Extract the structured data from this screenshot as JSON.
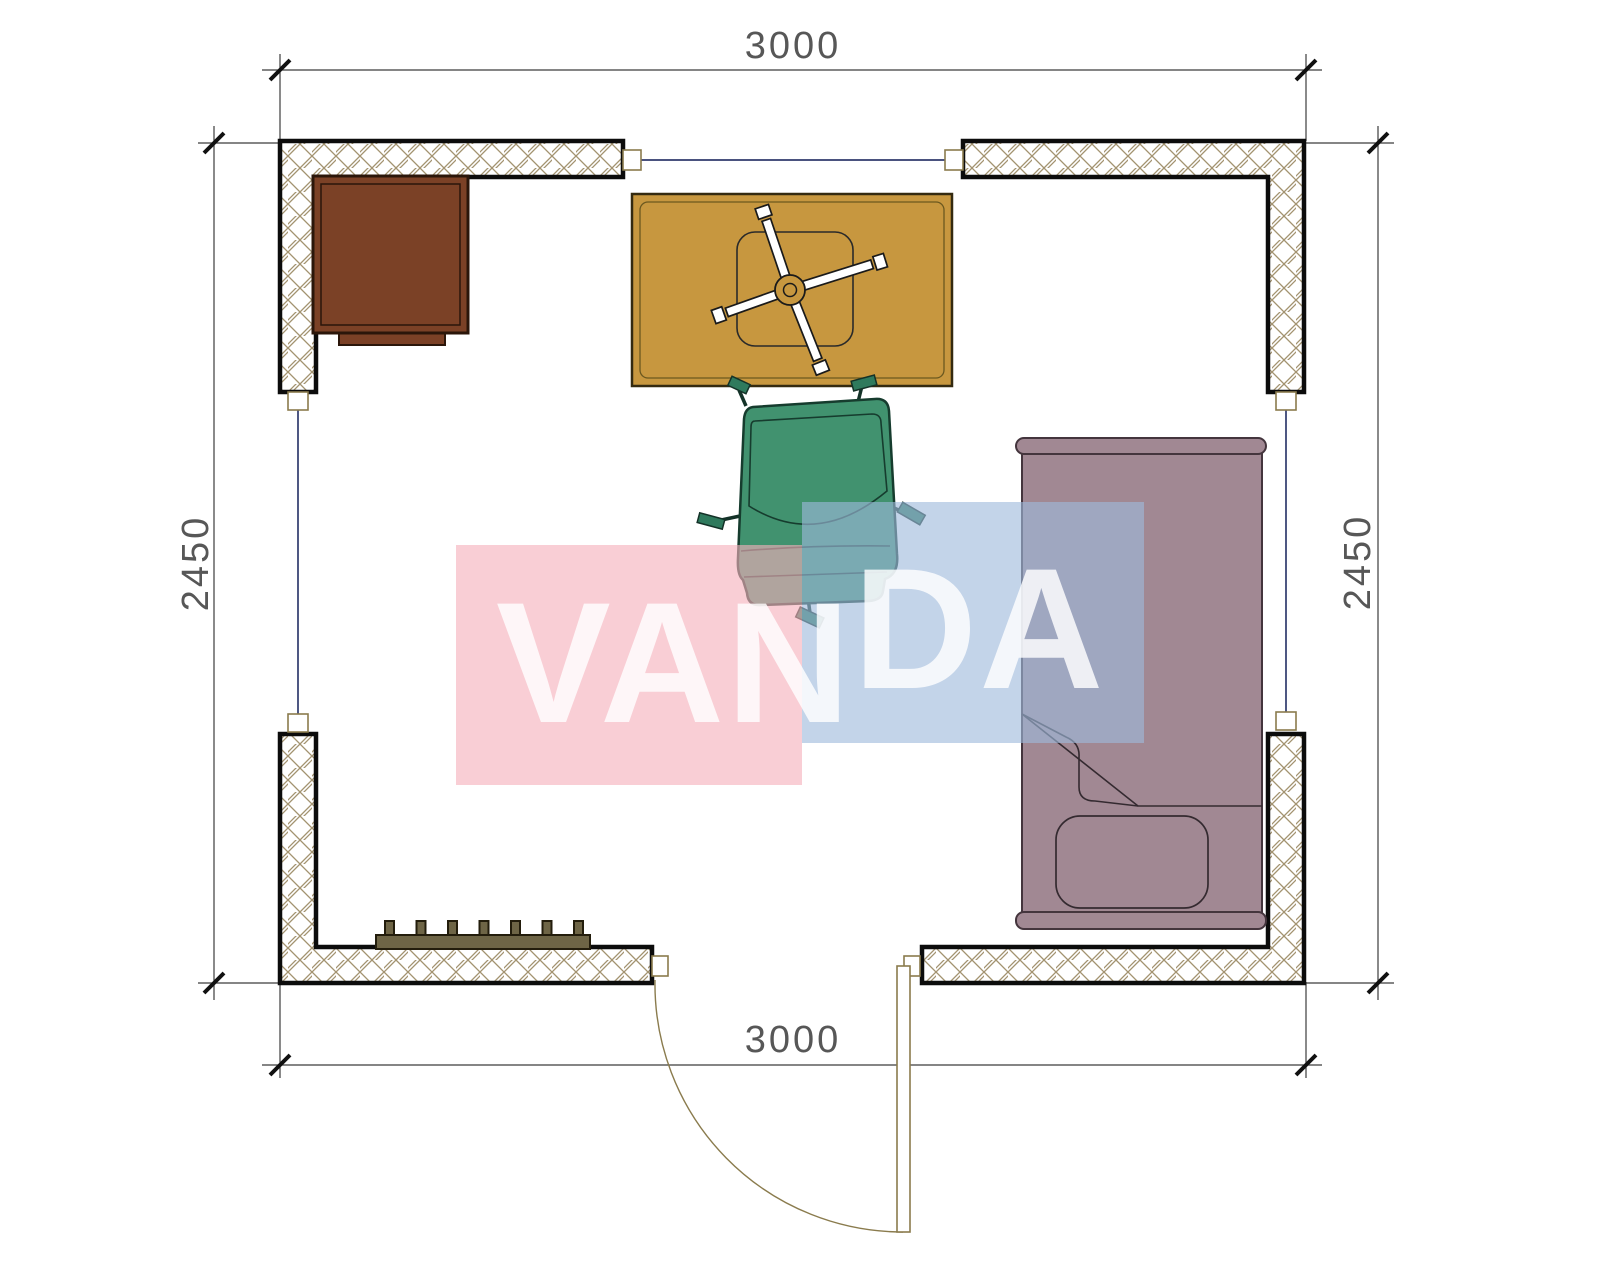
{
  "drawing": {
    "type": "room-floor-plan",
    "dimensions": {
      "top": "3000",
      "bottom": "3000",
      "left": "2450",
      "right": "2450"
    },
    "watermark": {
      "text": "VANDA",
      "part1": "VAN",
      "part2": "DA",
      "pink_fill": "rgba(245,176,188,0.62)",
      "blue_fill": "rgba(158,185,220,0.62)",
      "text_fill": "rgba(255,255,255,0.82)"
    },
    "colors": {
      "wall_border": "#0c0c0c",
      "hatch_line": "#a39370",
      "window_line": "#303a6d",
      "door_line": "#8a7b4d",
      "dim_line": "#3c3c3c",
      "tick": "#111111",
      "dim_text": "#575757",
      "cabinet_fill": "#7b4126",
      "cabinet_border": "#2b160a",
      "desk_fill": "#c7973f",
      "desk_border": "#342a10",
      "chair_fill": "#41926f",
      "chair_border": "#163c2e",
      "caster_fill": "#2f7a5d",
      "bed_fill": "#a18893",
      "bed_border": "#44353d",
      "bed_detail": "#342a30",
      "radiator_fill": "#6e6546",
      "radiator_border": "#231d0c"
    },
    "furniture_legend": [
      {
        "label": "cabinet"
      },
      {
        "label": "desk-with-swivel-chair-base"
      },
      {
        "label": "office-chair"
      },
      {
        "label": "bed"
      },
      {
        "label": "radiator"
      },
      {
        "label": "door"
      },
      {
        "label": "window"
      }
    ]
  }
}
